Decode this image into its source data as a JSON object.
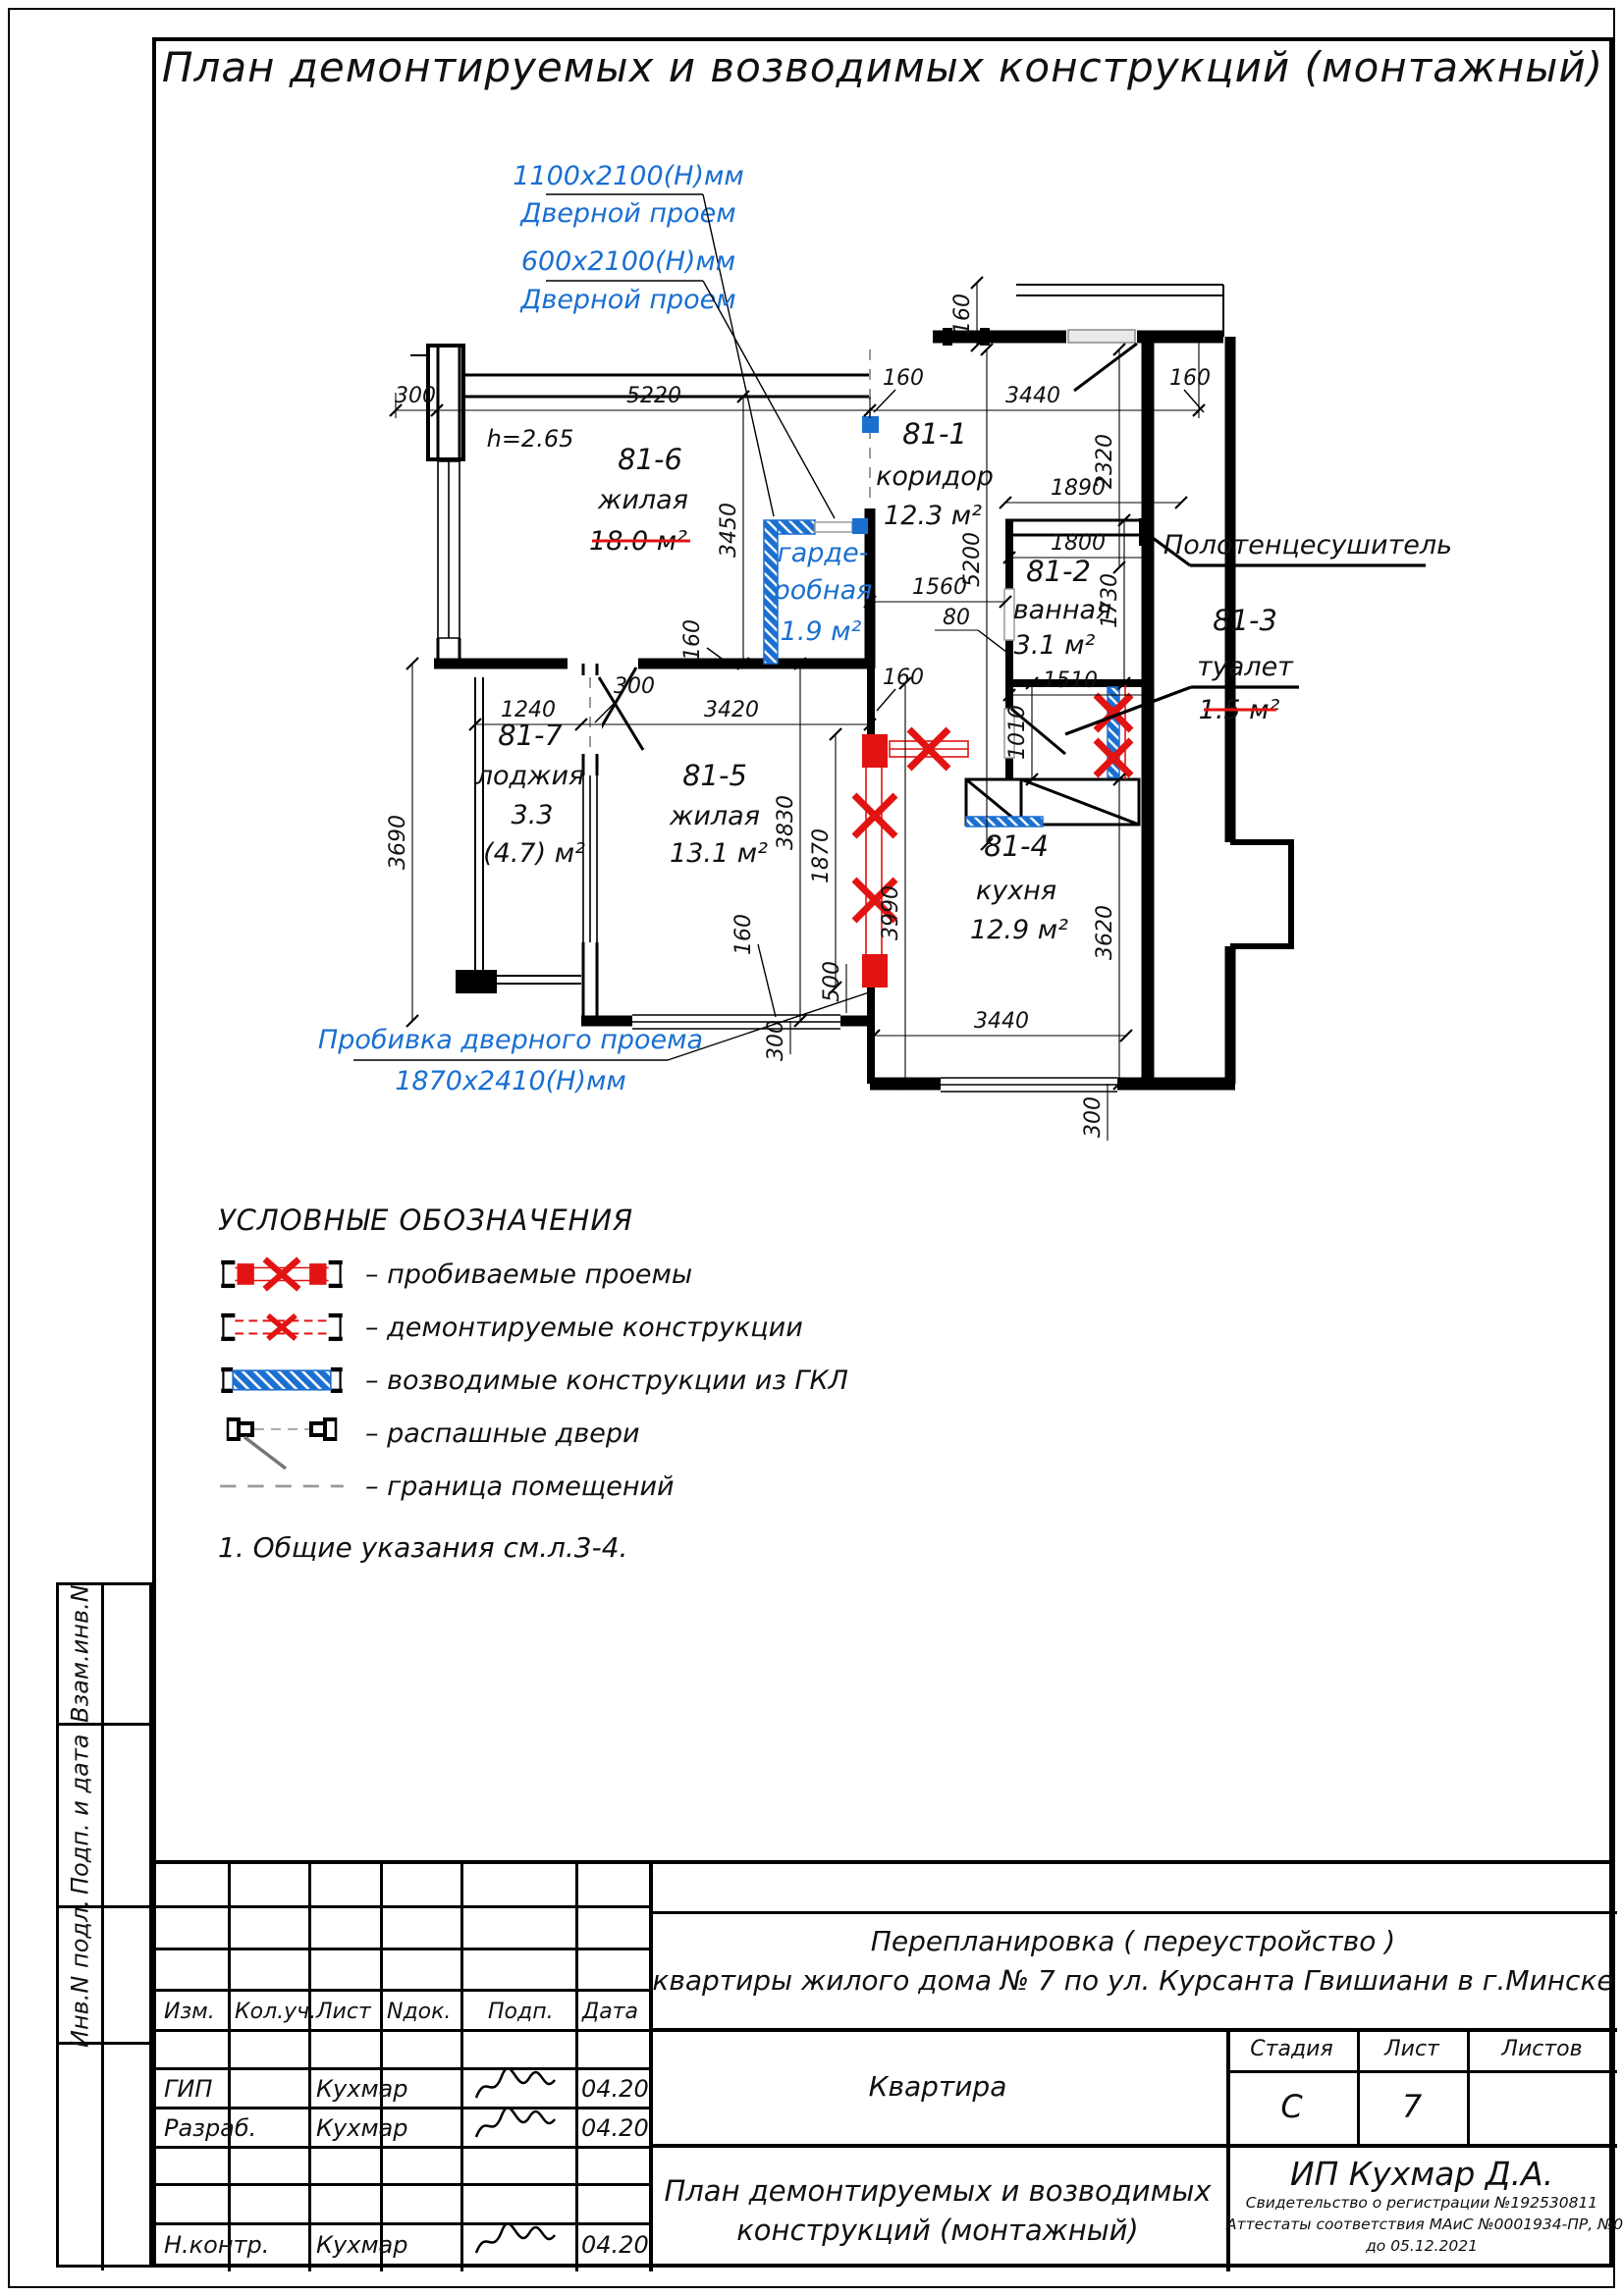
{
  "title": "План демонтируемых и возводимых конструкций (монтажный)",
  "plan": {
    "height_note": "h=2.65",
    "rooms": {
      "r81_1": {
        "id": "81-1",
        "name": "коридор",
        "area": "12.3 м²"
      },
      "r81_2": {
        "id": "81-2",
        "name": "ванная",
        "area": "3.1 м²"
      },
      "r81_3": {
        "id": "81-3",
        "name": "туалет",
        "area": "1.5 м²"
      },
      "r81_4": {
        "id": "81-4",
        "name": "кухня",
        "area": "12.9 м²"
      },
      "r81_5": {
        "id": "81-5",
        "name": "жилая",
        "area": "13.1 м²"
      },
      "r81_6": {
        "id": "81-6",
        "name": "жилая",
        "area": "18.0 м²"
      },
      "r81_7": {
        "id": "81-7",
        "name": "лоджия",
        "area": "3.3",
        "area_alt": "(4.7) м²"
      },
      "wardrobe": {
        "name_line1": "гарде-",
        "name_line2": "робная",
        "area": "1.9 м²"
      }
    },
    "annotations": {
      "door1_size": "1100x2100(Н)мм",
      "door1_label": "Дверной проем",
      "door2_size": "600x2100(Н)мм",
      "door2_label": "Дверной проем",
      "punch_label": "Пробивка дверного проема",
      "punch_size": "1870x2410(Н)мм",
      "towel_rail": "Полотенцесушитель"
    },
    "dims": {
      "300": "300",
      "5220": "5220",
      "3440": "3440",
      "160": "160",
      "2320": "2320",
      "3450": "3450",
      "5200": "5200",
      "1560": "1560",
      "80": "80",
      "1890": "1890",
      "1800": "1800",
      "1730": "1730",
      "1510": "1510",
      "1010": "1010",
      "1240": "1240",
      "3420": "3420",
      "3690": "3690",
      "3830": "3830",
      "1870": "1870",
      "500": "500",
      "3990": "3990",
      "3620": "3620"
    }
  },
  "legend": {
    "title": "УСЛОВНЫЕ ОБОЗНАЧЕНИЯ",
    "items": [
      {
        "label": "–  пробиваемые проемы"
      },
      {
        "label": "–  демонтируемые конструкции"
      },
      {
        "label": "–  возводимые конструкции  из  ГКЛ"
      },
      {
        "label": "–  распашные двери"
      },
      {
        "label": "–  граница помещений"
      }
    ],
    "note": "1.  Общие указания см.л.3-4."
  },
  "titleblock": {
    "headers": [
      "Изм.",
      "Кол.уч.",
      "Лист",
      "Nдок.",
      "Подп.",
      "Дата"
    ],
    "rows": [
      {
        "role": "ГИП",
        "name": "Кухмар",
        "date": "04.20"
      },
      {
        "role": "Разраб.",
        "name": "Кухмар",
        "date": "04.20"
      },
      {
        "role": "Н.контр.",
        "name": "Кухмар",
        "date": "04.20"
      }
    ],
    "project_line1": "Перепланировка  ( переустройство )",
    "project_line2": "квартиры жилого дома  № 7  по ул. Курсанта Гвишиани  в  г.Минске",
    "object_name": "Квартира",
    "stage_label": "Стадия",
    "sheet_label": "Лист",
    "sheets_label": "Листов",
    "stage_value": "С",
    "sheet_value": "7",
    "sheets_value": "",
    "doc_line1": "План демонтируемых и возводимых",
    "doc_line2": "конструкций (монтажный)",
    "company": "ИП Кухмар Д.А.",
    "cert_line1": "Свидетельство о регистрации №192530811",
    "cert_line2": "Аттестаты соответствия МАиС  №0001934-ПР, №0002091-ПР",
    "cert_line3": "до  05.12.2021"
  },
  "sidebar": {
    "label1": "Взам.инв.N",
    "label2": "Подп. и дата",
    "label3": "Инв.N подл."
  }
}
